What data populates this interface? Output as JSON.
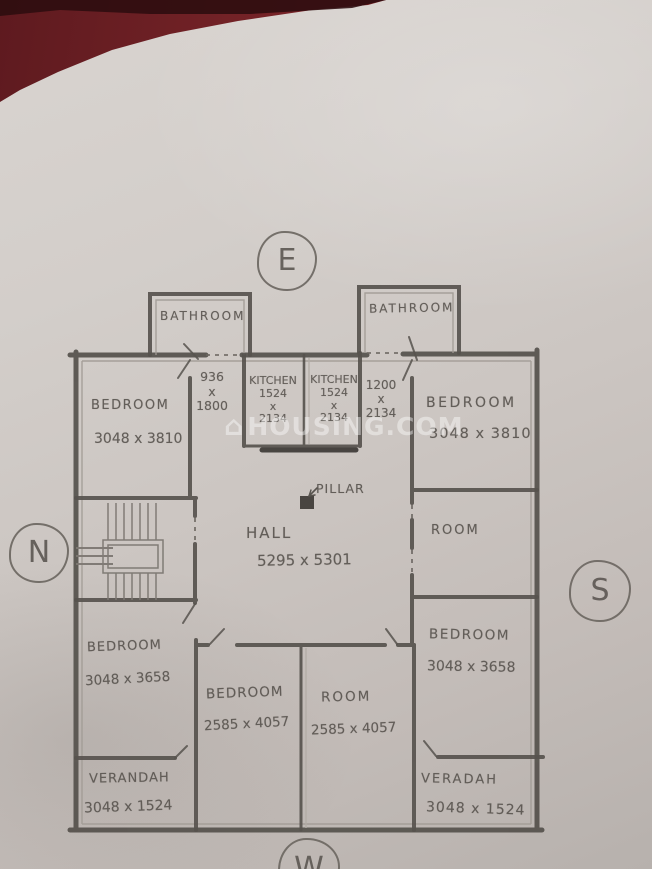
{
  "photo": {
    "description": "hand-drawn house floor plan sketch on paper, photographed on a red surface",
    "colors": {
      "paper": "#cec8c4",
      "pencil": "#57534e",
      "surface_red": "#7d262a",
      "watermark": "#ffffff"
    }
  },
  "watermark": {
    "icon": "house-icon",
    "icon_glyph": "⌂",
    "text": "HOUSING.COM"
  },
  "compass": {
    "east": "E",
    "north": "N",
    "south": "S",
    "west": "W"
  },
  "rooms": {
    "bathroom_left": {
      "label": "BATHROOM"
    },
    "bathroom_right": {
      "label": "BATHROOM"
    },
    "bedroom_top_left": {
      "label": "BEDROOM",
      "dims": "3048 x 3810"
    },
    "passage_left": {
      "width": "936",
      "times": "x",
      "depth": "1800"
    },
    "kitchen_left": {
      "label": "KITCHEN",
      "width": "1524",
      "times": "x",
      "depth": "2134"
    },
    "kitchen_right": {
      "label": "KITCHEN",
      "width": "1524",
      "times": "x",
      "depth": "2134"
    },
    "passage_right": {
      "width": "1200",
      "times": "x",
      "depth": "2134"
    },
    "bedroom_top_right": {
      "label": "BEDROOM",
      "dims": "3048 x 3810"
    },
    "hall": {
      "label": "HALL",
      "dims": "5295 x 5301"
    },
    "pillar": {
      "label": "PILLAR"
    },
    "room_middle_right": {
      "label": "ROOM"
    },
    "bedroom_bottom_left": {
      "label": "BEDROOM",
      "dims": "3048 x 3658"
    },
    "bedroom_bottom_center": {
      "label": "BEDROOM",
      "dims": "2585 x 4057"
    },
    "room_bottom_center": {
      "label": "ROOM",
      "dims": "2585 x 4057"
    },
    "bedroom_bottom_right": {
      "label": "BEDROOM",
      "dims": "3048 x 3658"
    },
    "verandah_left": {
      "label": "VERANDAH",
      "dims": "3048 x 1524"
    },
    "verandah_right": {
      "label": "VERADAH",
      "dims": "3048 x 1524"
    }
  }
}
